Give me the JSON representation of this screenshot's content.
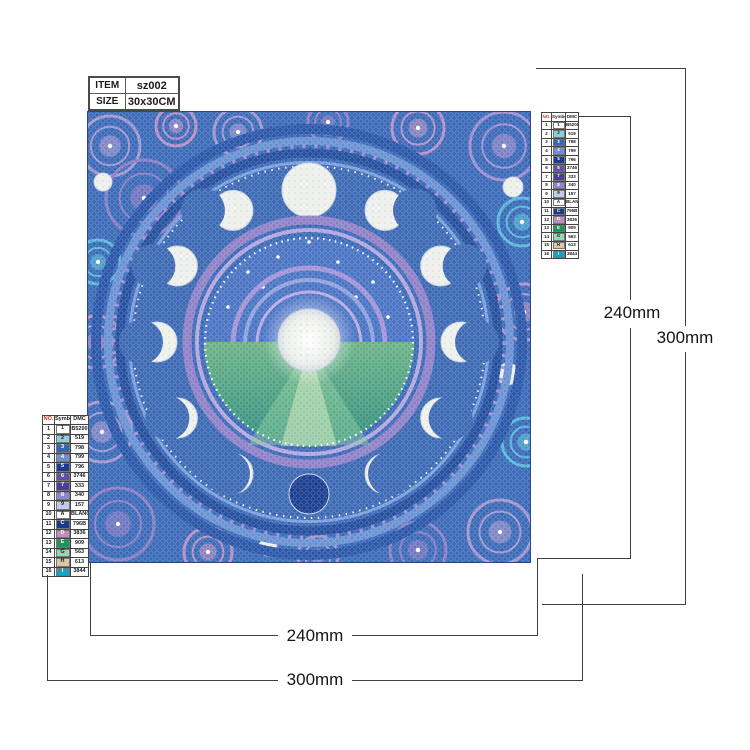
{
  "item_table": {
    "rows": [
      {
        "label": "ITEM",
        "value": "sz002"
      },
      {
        "label": "SIZE",
        "value": "30x30CM"
      }
    ]
  },
  "dimension_labels": {
    "right_inner": "240mm",
    "right_outer": "300mm",
    "bottom_inner": "240mm",
    "bottom_outer": "300mm"
  },
  "color_chart": {
    "headers": [
      "NO.",
      "Symbol",
      "DMC"
    ],
    "rows": [
      {
        "no": "1",
        "symbol": "1",
        "dmc": "B5200",
        "chip": "#ffffff",
        "text": "#222222"
      },
      {
        "no": "2",
        "symbol": "2",
        "dmc": "519",
        "chip": "#8fcadd",
        "text": "#222222"
      },
      {
        "no": "3",
        "symbol": "3",
        "dmc": "798",
        "chip": "#3466b4",
        "text": "#ffffff"
      },
      {
        "no": "4",
        "symbol": "4",
        "dmc": "799",
        "chip": "#6e8fd2",
        "text": "#ffffff"
      },
      {
        "no": "5",
        "symbol": "5",
        "dmc": "796",
        "chip": "#1b3c8e",
        "text": "#ffffff"
      },
      {
        "no": "6",
        "symbol": "6",
        "dmc": "3746",
        "chip": "#5c51ab",
        "text": "#ffffff"
      },
      {
        "no": "7",
        "symbol": "7",
        "dmc": "333",
        "chip": "#4a3e99",
        "text": "#ffffff"
      },
      {
        "no": "8",
        "symbol": "8",
        "dmc": "340",
        "chip": "#8d87d2",
        "text": "#ffffff"
      },
      {
        "no": "9",
        "symbol": "9",
        "dmc": "157",
        "chip": "#c0cbec",
        "text": "#222222"
      },
      {
        "no": "10",
        "symbol": "A",
        "dmc": "BLANC",
        "chip": "#ffffff",
        "text": "#222222"
      },
      {
        "no": "11",
        "symbol": "C",
        "dmc": "796B",
        "chip": "#1a3a8c",
        "text": "#ffffff"
      },
      {
        "no": "12",
        "symbol": "D",
        "dmc": "3836",
        "chip": "#c08cc5",
        "text": "#ffffff"
      },
      {
        "no": "13",
        "symbol": "E",
        "dmc": "909",
        "chip": "#169a57",
        "text": "#ffffff"
      },
      {
        "no": "14",
        "symbol": "G",
        "dmc": "563",
        "chip": "#93d7b5",
        "text": "#222222"
      },
      {
        "no": "15",
        "symbol": "H",
        "dmc": "613",
        "chip": "#d7c9a6",
        "text": "#222222"
      },
      {
        "no": "16",
        "symbol": "I",
        "dmc": "3844",
        "chip": "#14a3c6",
        "text": "#ffffff"
      }
    ]
  },
  "artwork_colors": {
    "base_blue": "#3b6ab8",
    "deep_blue": "#2a57a9",
    "light_blue": "#6a92d4",
    "purple_band": "#8f81c8",
    "lavender": "#a296d0",
    "orchid": "#b78fc6",
    "cyan_ring": "#56b9d8",
    "moon_white": "#eef0ec",
    "new_moon": "#1c3e90",
    "sea_green": "#4fa478"
  }
}
